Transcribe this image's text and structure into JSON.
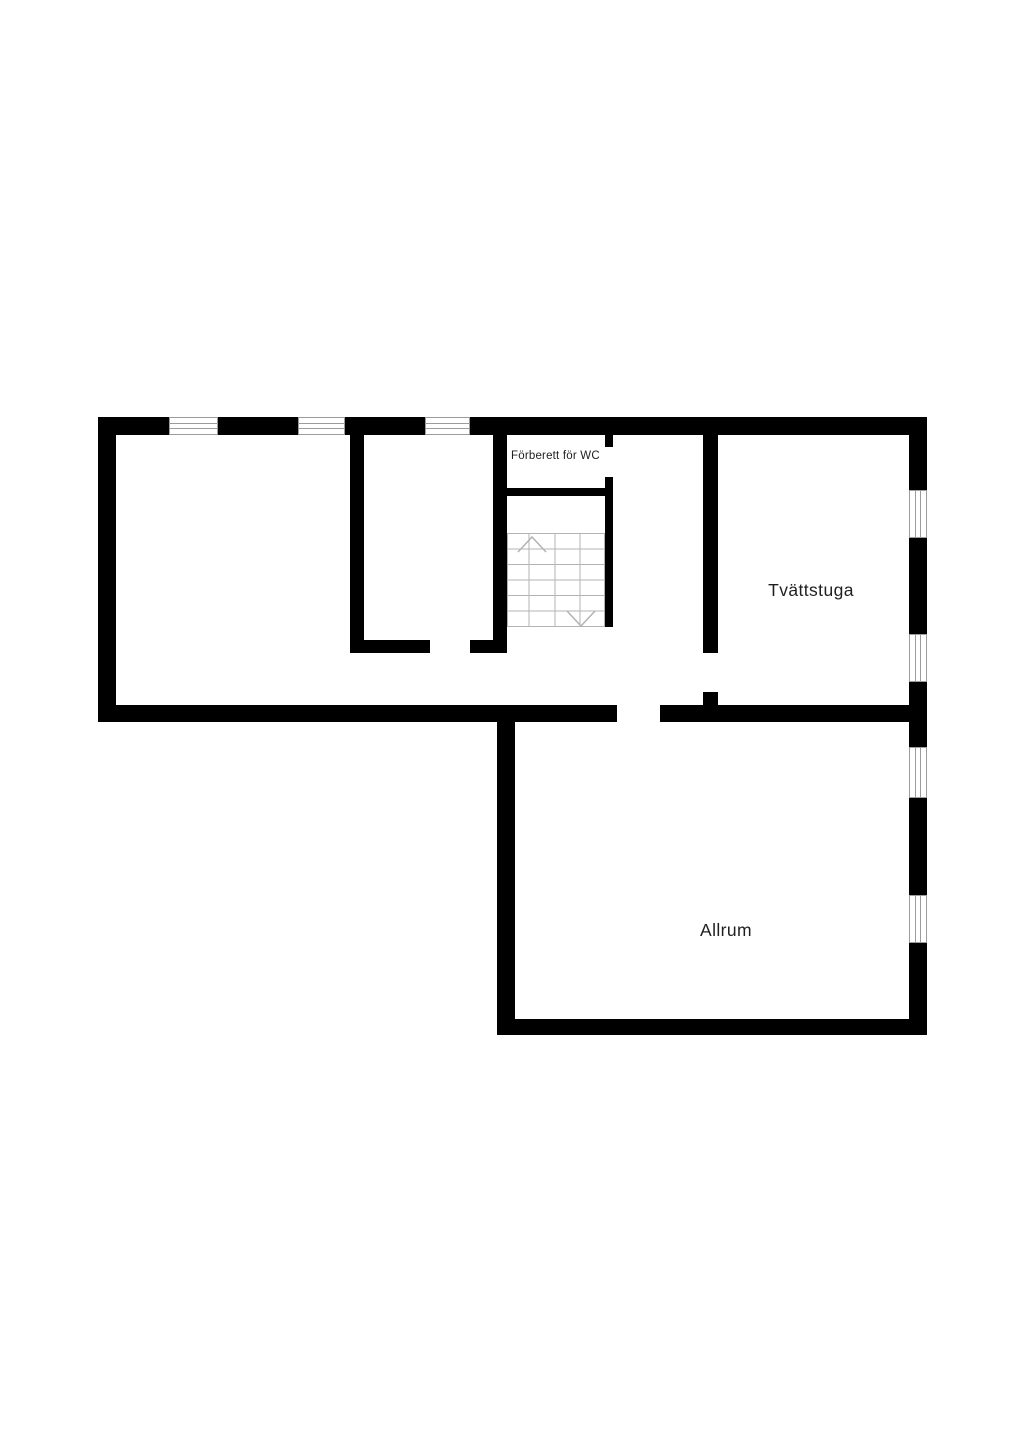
{
  "document": {
    "type": "floor-plan"
  },
  "labels": {
    "wc": "Förberett för WC",
    "laundry": "Tvättstuga",
    "family_room": "Allrum"
  },
  "colors": {
    "background": "#ffffff",
    "wall": "#000000",
    "window_frame": "#9c9c9c",
    "stair_lines": "#b3b3b3",
    "label_text": "#1f1f1f"
  },
  "stairs": {
    "tread_rows": 6,
    "columns": 4,
    "up_arrow": "top-left",
    "down_arrow": "bottom-right"
  }
}
